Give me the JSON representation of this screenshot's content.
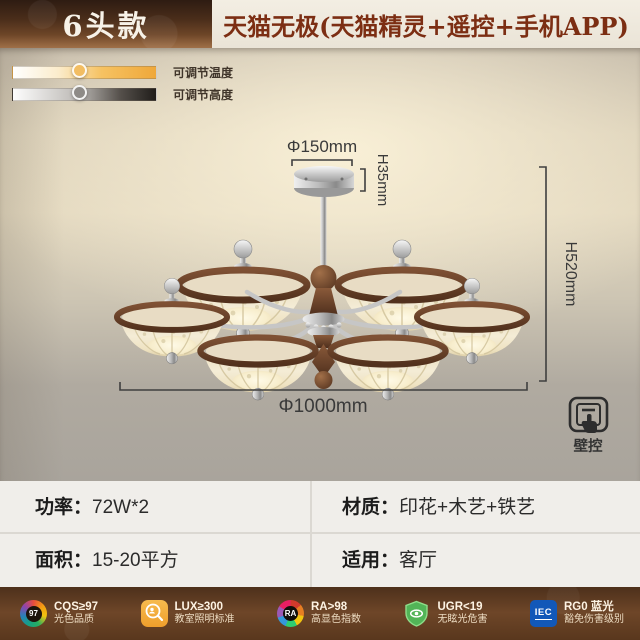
{
  "header": {
    "badge": "6头款",
    "title": "天猫无极(天猫精灵+遥控+手机APP)"
  },
  "features": {
    "temperature": {
      "label": "可调节温度"
    },
    "height": {
      "label": "可调节高度"
    }
  },
  "diagram": {
    "canopy_diameter": "Φ150mm",
    "canopy_height": "H35mm",
    "fixture_height": "H520mm",
    "fixture_diameter": "Φ1000mm",
    "wall_control": "壁控"
  },
  "specs": {
    "power_label": "功率：",
    "power_value": "72W*2",
    "material_label": "材质：",
    "material_value": "印花+木艺+铁艺",
    "area_label": "面积：",
    "area_value": "15-20平方",
    "usage_label": "适用：",
    "usage_value": "客厅"
  },
  "certs": [
    {
      "icon": "cqs-badge-icon",
      "icon_text": "97",
      "line1": "CQS≥97",
      "line2": "光色品质"
    },
    {
      "icon": "lux-magnifier-icon",
      "line1": "LUX≥300",
      "line2": "教室照明标准"
    },
    {
      "icon": "ra-color-wheel-icon",
      "icon_text": "RA",
      "line1": "RA>98",
      "line2": "高显色指数"
    },
    {
      "icon": "ugr-shield-eye-icon",
      "line1": "UGR<19",
      "line2": "无眩光危害"
    },
    {
      "icon": "iec-logo-icon",
      "icon_text": "IEC",
      "line1": "RG0 蓝光",
      "line2": "豁免伤害级别"
    }
  ],
  "colors": {
    "accent_title_brown": "#7c2e13",
    "badge_gradient_bottom": "#a07048",
    "slider_orange": "#efa83a",
    "footer_brown": "#6e4628",
    "cert_green": "#4cae4f",
    "cert_blue": "#1258b8",
    "cert_orange": "#f2a93b",
    "wood_brown": "#6b4329",
    "shade_cream": "#f0e6cc"
  }
}
